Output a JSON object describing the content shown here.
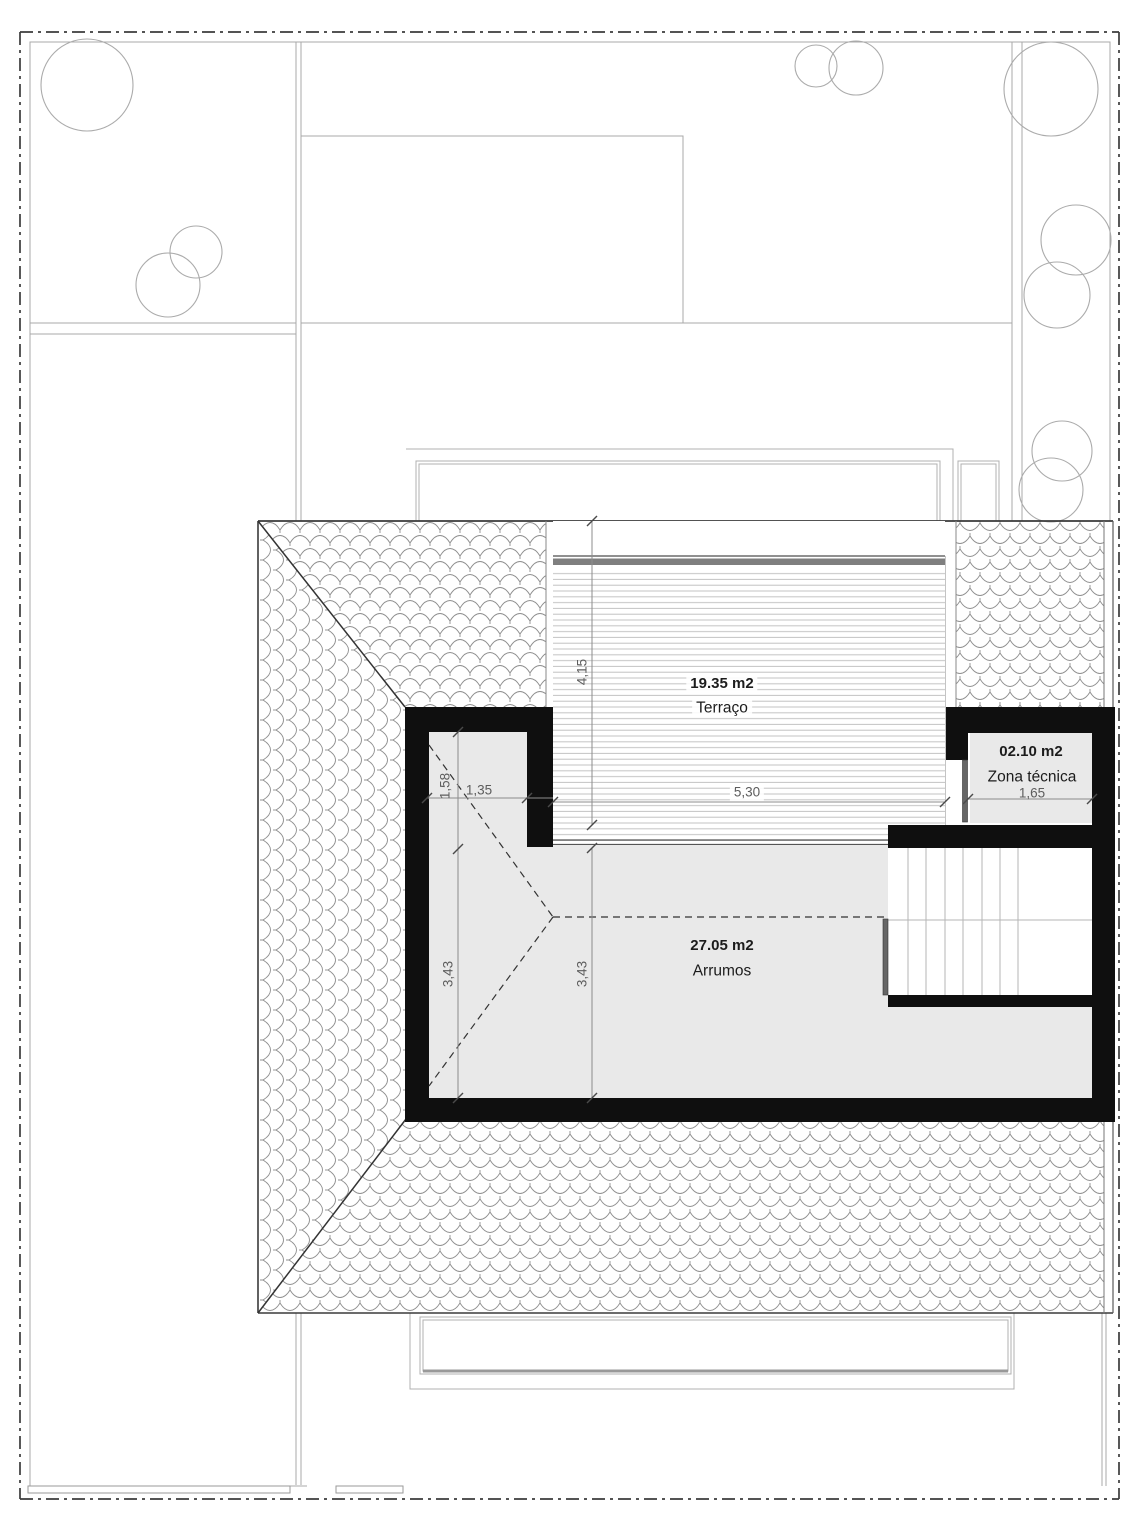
{
  "plan": {
    "rooms": {
      "terraco": {
        "area": "19.35 m2",
        "name": "Terraço"
      },
      "arrumos": {
        "area": "27.05 m2",
        "name": "Arrumos"
      },
      "zona_tecnica": {
        "area": "02.10 m2",
        "name": "Zona técnica"
      }
    },
    "dimensions": {
      "terraco_depth": "4,15",
      "terraco_width": "5,30",
      "nook_width": "1,35",
      "nook_depth": "1,58",
      "arrumos_depth_left": "3,43",
      "arrumos_depth_mid": "3,43",
      "zona_tecnica_width": "1,65"
    },
    "icons": {
      "tree": "tree-canopy-circle",
      "stairs": "stair-treads",
      "door": "door-leaf",
      "roof": "roof-tile-hatch"
    },
    "colors": {
      "wall_fill": "#0f0f0f",
      "room_fill": "#e9e9e9",
      "terrace_band": "#7f7f7f",
      "deck_line": "#c2c2c2",
      "tile_line": "#8f8f8f",
      "thin_line": "#aeaeae",
      "boundary_line": "#3c3c3c",
      "dimension": "#5d5d5d"
    }
  }
}
